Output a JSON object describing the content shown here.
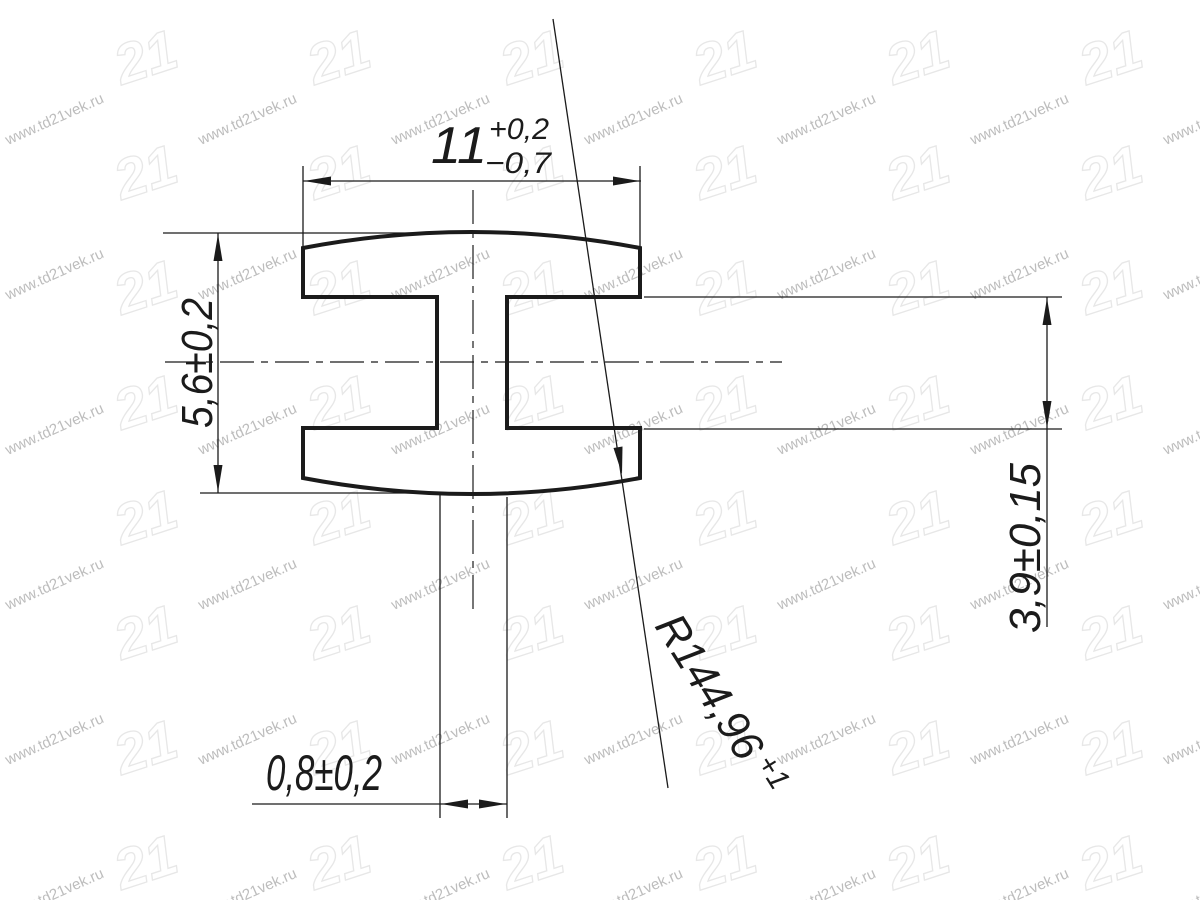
{
  "drawing": {
    "width": {
      "value": "11",
      "upper": "+0,2",
      "lower": "−0,7"
    },
    "outer_height": "5,6±0,2",
    "inner_height": "3,9±0,15",
    "web_thickness": "0,8±0,2",
    "radius": {
      "value": "R144,96",
      "upper": "+1"
    }
  },
  "watermark": {
    "url": "www.td21vek.ru",
    "logo": "21"
  },
  "colors": {
    "line": "#1b1b1b",
    "watermark_text": "#bdbdbd",
    "watermark_logo": "#e7e7e7",
    "background": "#ffffff"
  }
}
